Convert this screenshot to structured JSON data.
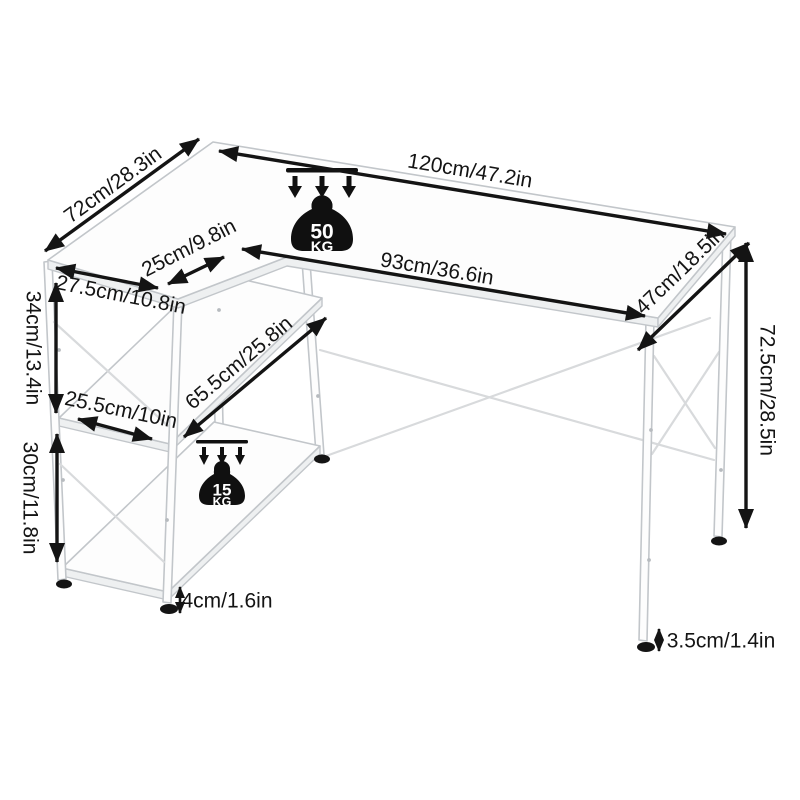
{
  "diagram": {
    "type": "product-dimension-diagram",
    "product": "L-shaped computer desk with storage shelves",
    "dimensions": {
      "desk_length": "120cm/47.2in",
      "return_depth": "72cm/28.3in",
      "return_overhang": "25cm/9.8in",
      "shelf_unit_width": "27.5cm/10.8in",
      "knee_space_width": "93cm/36.6in",
      "desk_depth": "47cm/18.5in",
      "desk_height": "72.5cm/28.5in",
      "upper_shelf_clearance": "34cm/13.4in",
      "shelf_inner_width": "25.5cm/10in",
      "shelf_length": "65.5cm/25.8in",
      "lower_shelf_clearance": "30cm/11.8in",
      "left_foot_height": "4cm/1.6in",
      "right_foot_height": "3.5cm/1.4in"
    },
    "load_capacity": {
      "desktop": {
        "value": "50",
        "unit": "KG"
      },
      "shelf": {
        "value": "15",
        "unit": "KG"
      }
    },
    "icons": {
      "load_desktop": "weight-50kg-icon",
      "load_shelf": "weight-15kg-icon",
      "load_direction": "triple-down-arrows"
    },
    "colors": {
      "background": "#ffffff",
      "line": "#141414",
      "desk_outline": "#c2c6ca",
      "desk_fill": "#fdfdfd",
      "desk_shade": "#eef0f1",
      "brace": "#d8dadc",
      "foot": "#141414",
      "badge": "#101010",
      "badge_text": "#ffffff"
    }
  }
}
